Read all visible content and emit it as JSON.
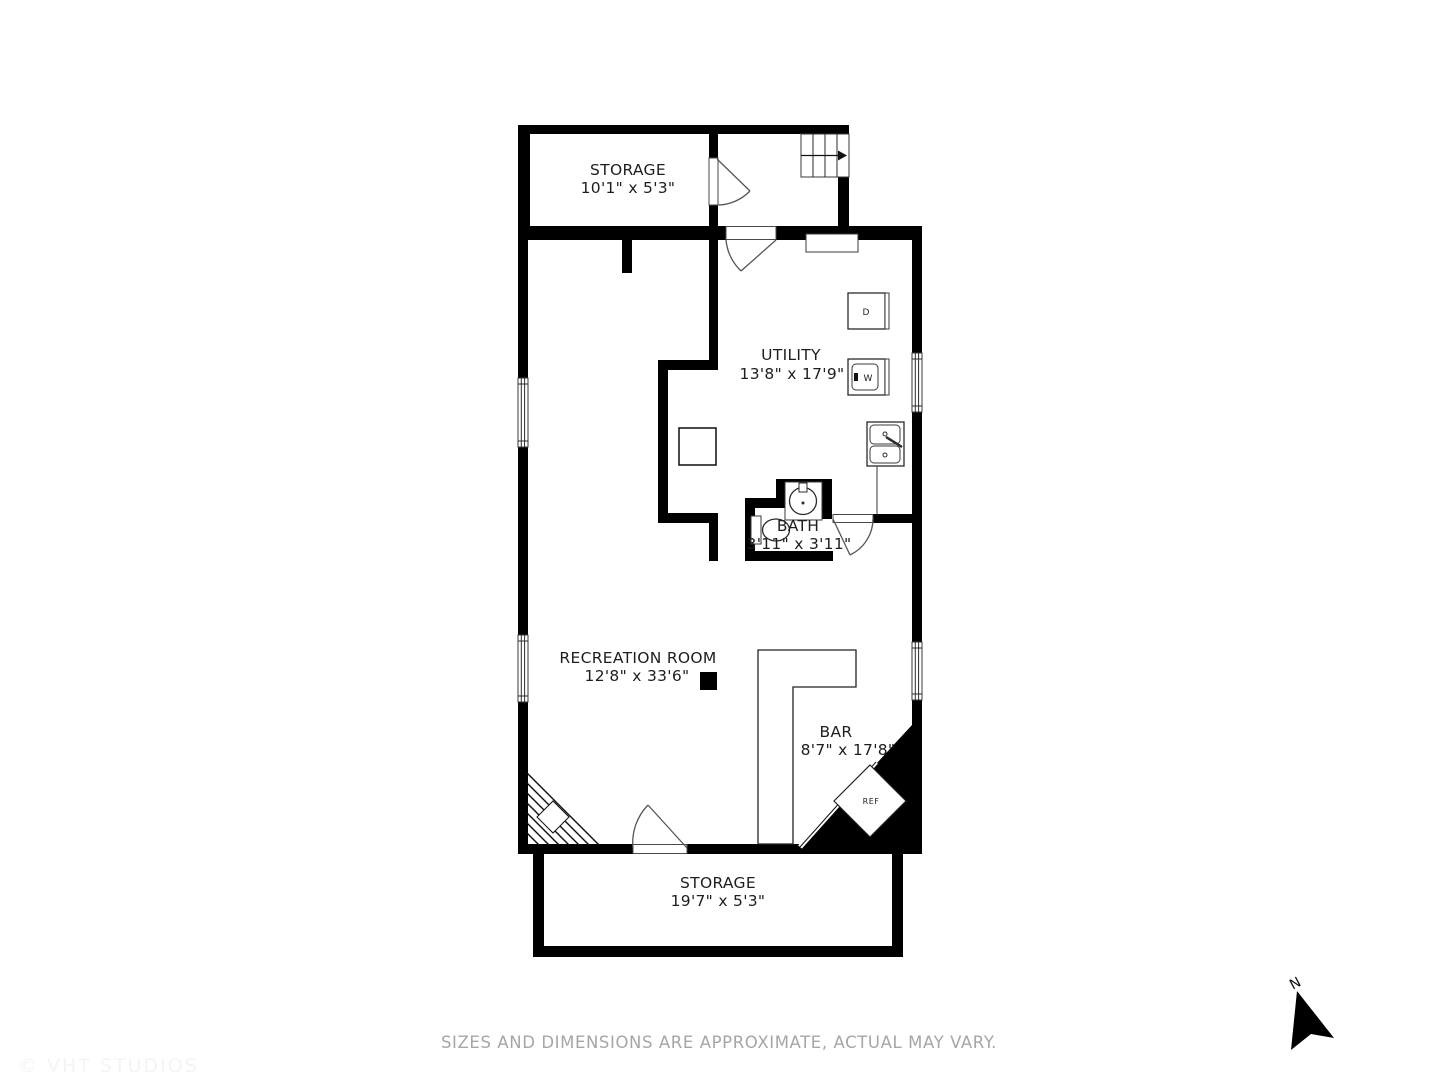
{
  "plan": {
    "rooms": [
      {
        "id": "storage-top",
        "name": "STORAGE",
        "dims": "10'1\" x 5'3\""
      },
      {
        "id": "utility",
        "name": "UTILITY",
        "dims": "13'8\" x 17'9\""
      },
      {
        "id": "bath",
        "name": "BATH",
        "dims": "3'11\" x 3'11\""
      },
      {
        "id": "recreation",
        "name": "RECREATION ROOM",
        "dims": "12'8\" x 33'6\""
      },
      {
        "id": "bar",
        "name": "BAR",
        "dims": "8'7\" x 17'8\""
      },
      {
        "id": "storage-bottom",
        "name": "STORAGE",
        "dims": "19'7\" x 5'3\""
      }
    ],
    "fixtures": {
      "dryer_label": "D",
      "washer_label": "W",
      "fridge_label": "REF"
    },
    "compass_label": "N",
    "disclaimer": "SIZES AND DIMENSIONS ARE APPROXIMATE, ACTUAL MAY VARY.",
    "watermark": "© VHT STUDIOS",
    "colors": {
      "wall": "#000000",
      "label_text": "#1e1e1e",
      "disclaimer_text": "#a6a6a6",
      "background": "#ffffff"
    }
  }
}
